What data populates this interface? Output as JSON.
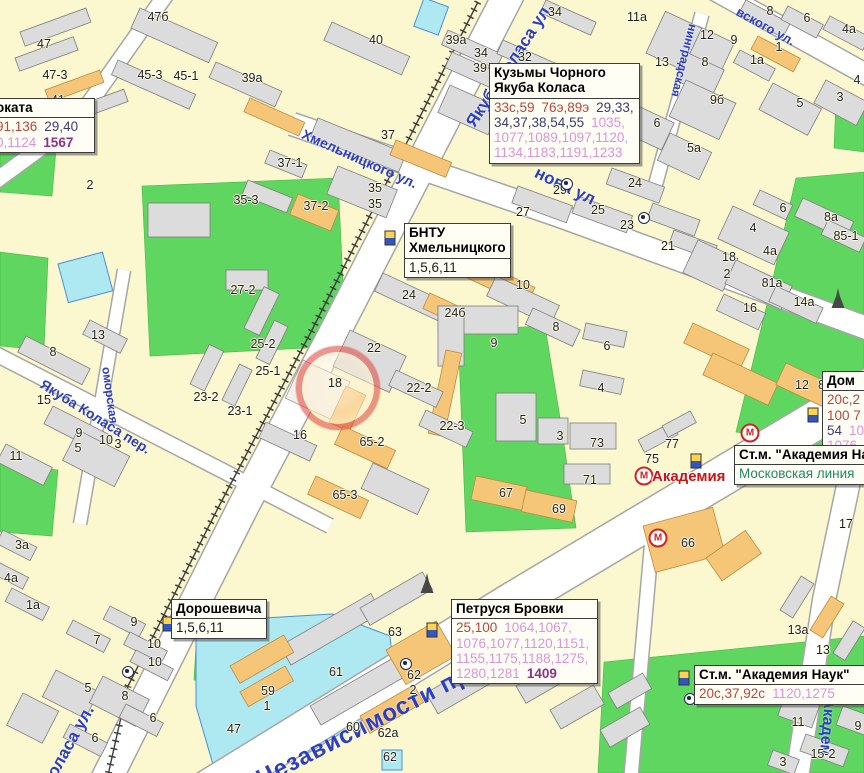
{
  "colors": {
    "map_background": "#FBF7CE",
    "park_green": "#5FD65F",
    "water_cyan": "#AEE9F2",
    "building_gray": "#DCDCDC",
    "building_orange": "#F5C678",
    "street_label_blue": "#2B3FC0",
    "tram_route_red": "#BB4538",
    "bus_route_navy": "#3C3C74",
    "shuttle_route_pink": "#DD92DC",
    "express_purple": "#8E3090",
    "metro_line_teal": "#1E8A66",
    "station_label_red": "#CE1212",
    "highlight_ring_red": "#E05048"
  },
  "icon_glyphs": {
    "metro": "М"
  },
  "street_labels": [
    {
      "name": "yakuba-kolasa-st",
      "text": "Якуба Коласа ул.",
      "x": 462,
      "y": 120,
      "rot": -57,
      "size": 17
    },
    {
      "name": "khmelnitskogo-st",
      "text": "Хмельницкого ул.",
      "x": 306,
      "y": 126,
      "rot": 24,
      "size": 14
    },
    {
      "name": "surganova-st-fragment",
      "text": "нова ул.",
      "x": 540,
      "y": 163,
      "rot": 26,
      "size": 17
    },
    {
      "name": "nezavisimosti-ave",
      "text": "Независимости просп",
      "x": 252,
      "y": 768,
      "rot": -27,
      "size": 24
    },
    {
      "name": "akademicheskaya-st-fragment",
      "text": "Академ",
      "x": 838,
      "y": 698,
      "rot": 95,
      "size": 16
    },
    {
      "name": "belomorskaya-st-fragment",
      "text": "оморская",
      "x": 113,
      "y": 366,
      "rot": 82,
      "size": 12
    },
    {
      "name": "yakuba-kolasa-lane",
      "text": "Якуба Коласа пер.",
      "x": 46,
      "y": 376,
      "rot": 32,
      "size": 14
    },
    {
      "name": "kolasa-st-fragment",
      "text": "Коласа ул.",
      "x": 38,
      "y": 780,
      "rot": -61,
      "size": 17
    },
    {
      "name": "chernyshevskogo-st-fragment",
      "text": "вского ул.",
      "x": 741,
      "y": 4,
      "rot": 29,
      "size": 13
    },
    {
      "name": "leningradskaya-st-fragment",
      "text": "нинградская",
      "x": 700,
      "y": 26,
      "rot": 104,
      "size": 12
    }
  ],
  "building_labels": [
    {
      "t": "47б",
      "x": 158,
      "y": 17
    },
    {
      "t": "47",
      "x": 44,
      "y": 44
    },
    {
      "t": "47-3",
      "x": 55,
      "y": 75
    },
    {
      "t": "45-3",
      "x": 150,
      "y": 75
    },
    {
      "t": "45-1",
      "x": 186,
      "y": 76
    },
    {
      "t": "41",
      "x": 58,
      "y": 100
    },
    {
      "t": "43",
      "x": 85,
      "y": 113
    },
    {
      "t": "40",
      "x": 376,
      "y": 40
    },
    {
      "t": "39а",
      "x": 456,
      "y": 40
    },
    {
      "t": "34",
      "x": 481,
      "y": 53
    },
    {
      "t": "39",
      "x": 480,
      "y": 68
    },
    {
      "t": "32",
      "x": 525,
      "y": 57
    },
    {
      "t": "34",
      "x": 555,
      "y": 12
    },
    {
      "t": "39а",
      "x": 252,
      "y": 78
    },
    {
      "t": "37-1",
      "x": 290,
      "y": 163
    },
    {
      "t": "37",
      "x": 388,
      "y": 135
    },
    {
      "t": "35-3",
      "x": 246,
      "y": 200
    },
    {
      "t": "37-2",
      "x": 316,
      "y": 206
    },
    {
      "t": "35",
      "x": 375,
      "y": 188
    },
    {
      "t": "35",
      "x": 375,
      "y": 204
    },
    {
      "t": "2",
      "x": 90,
      "y": 185
    },
    {
      "t": "27-2",
      "x": 243,
      "y": 290
    },
    {
      "t": "25-2",
      "x": 263,
      "y": 344
    },
    {
      "t": "25-1",
      "x": 268,
      "y": 371
    },
    {
      "t": "23-2",
      "x": 206,
      "y": 397
    },
    {
      "t": "23-1",
      "x": 240,
      "y": 411
    },
    {
      "t": "13",
      "x": 98,
      "y": 335
    },
    {
      "t": "8",
      "x": 53,
      "y": 352
    },
    {
      "t": "15",
      "x": 44,
      "y": 400
    },
    {
      "t": "9",
      "x": 79,
      "y": 433
    },
    {
      "t": "5",
      "x": 78,
      "y": 448
    },
    {
      "t": "10",
      "x": 106,
      "y": 440
    },
    {
      "t": "3",
      "x": 118,
      "y": 444
    },
    {
      "t": "11",
      "x": 16,
      "y": 456
    },
    {
      "t": "11а",
      "x": 637,
      "y": 17
    },
    {
      "t": "12",
      "x": 707,
      "y": 35
    },
    {
      "t": "9",
      "x": 734,
      "y": 40
    },
    {
      "t": "13",
      "x": 662,
      "y": 62
    },
    {
      "t": "8",
      "x": 705,
      "y": 62
    },
    {
      "t": "9б",
      "x": 717,
      "y": 100
    },
    {
      "t": "6",
      "x": 657,
      "y": 123
    },
    {
      "t": "5а",
      "x": 694,
      "y": 148
    },
    {
      "t": "8",
      "x": 770,
      "y": 11
    },
    {
      "t": "6",
      "x": 807,
      "y": 18
    },
    {
      "t": "4а",
      "x": 849,
      "y": 29
    },
    {
      "t": "1",
      "x": 779,
      "y": 47
    },
    {
      "t": "1а",
      "x": 757,
      "y": 60
    },
    {
      "t": "5",
      "x": 800,
      "y": 103
    },
    {
      "t": "3",
      "x": 840,
      "y": 97
    },
    {
      "t": "4",
      "x": 857,
      "y": 80
    },
    {
      "t": "29",
      "x": 560,
      "y": 190
    },
    {
      "t": "27",
      "x": 523,
      "y": 212
    },
    {
      "t": "25",
      "x": 598,
      "y": 210
    },
    {
      "t": "24",
      "x": 635,
      "y": 183
    },
    {
      "t": "23",
      "x": 627,
      "y": 225
    },
    {
      "t": "21",
      "x": 668,
      "y": 246
    },
    {
      "t": "24",
      "x": 409,
      "y": 295
    },
    {
      "t": "24б",
      "x": 455,
      "y": 313
    },
    {
      "t": "10",
      "x": 523,
      "y": 285
    },
    {
      "t": "9",
      "x": 494,
      "y": 343
    },
    {
      "t": "8",
      "x": 556,
      "y": 327
    },
    {
      "t": "6",
      "x": 607,
      "y": 346
    },
    {
      "t": "4",
      "x": 601,
      "y": 388
    },
    {
      "t": "5",
      "x": 523,
      "y": 420
    },
    {
      "t": "3",
      "x": 560,
      "y": 436
    },
    {
      "t": "22",
      "x": 374,
      "y": 348
    },
    {
      "t": "18",
      "x": 335,
      "y": 383
    },
    {
      "t": "22-2",
      "x": 419,
      "y": 388
    },
    {
      "t": "22-3",
      "x": 452,
      "y": 426
    },
    {
      "t": "16",
      "x": 300,
      "y": 435
    },
    {
      "t": "65-2",
      "x": 372,
      "y": 442
    },
    {
      "t": "65-3",
      "x": 345,
      "y": 495
    },
    {
      "t": "73",
      "x": 597,
      "y": 443
    },
    {
      "t": "71",
      "x": 590,
      "y": 480
    },
    {
      "t": "67",
      "x": 506,
      "y": 493
    },
    {
      "t": "69",
      "x": 559,
      "y": 509
    },
    {
      "t": "18",
      "x": 729,
      "y": 257
    },
    {
      "t": "2",
      "x": 727,
      "y": 274
    },
    {
      "t": "4",
      "x": 753,
      "y": 228
    },
    {
      "t": "4а",
      "x": 770,
      "y": 251
    },
    {
      "t": "6",
      "x": 783,
      "y": 208
    },
    {
      "t": "8а",
      "x": 831,
      "y": 217
    },
    {
      "t": "85-1",
      "x": 846,
      "y": 236
    },
    {
      "t": "81а",
      "x": 772,
      "y": 283
    },
    {
      "t": "16",
      "x": 750,
      "y": 308
    },
    {
      "t": "14а",
      "x": 804,
      "y": 302
    },
    {
      "t": "12",
      "x": 802,
      "y": 385
    },
    {
      "t": "81",
      "x": 825,
      "y": 385
    },
    {
      "t": "75",
      "x": 652,
      "y": 459
    },
    {
      "t": "77",
      "x": 672,
      "y": 444
    },
    {
      "t": "66",
      "x": 688,
      "y": 543
    },
    {
      "t": "17",
      "x": 846,
      "y": 524
    },
    {
      "t": "47",
      "x": 234,
      "y": 729
    },
    {
      "t": "59",
      "x": 268,
      "y": 691
    },
    {
      "t": "1",
      "x": 267,
      "y": 706
    },
    {
      "t": "61",
      "x": 336,
      "y": 672
    },
    {
      "t": "63",
      "x": 395,
      "y": 632
    },
    {
      "t": "62",
      "x": 414,
      "y": 675
    },
    {
      "t": "2",
      "x": 413,
      "y": 690
    },
    {
      "t": "60",
      "x": 353,
      "y": 727
    },
    {
      "t": "62а",
      "x": 388,
      "y": 733
    },
    {
      "t": "62",
      "x": 390,
      "y": 757
    },
    {
      "t": "3а",
      "x": 22,
      "y": 545
    },
    {
      "t": "4а",
      "x": 11,
      "y": 578
    },
    {
      "t": "1а",
      "x": 33,
      "y": 605
    },
    {
      "t": "9",
      "x": 134,
      "y": 622
    },
    {
      "t": "7",
      "x": 97,
      "y": 640
    },
    {
      "t": "10",
      "x": 154,
      "y": 644
    },
    {
      "t": "10",
      "x": 155,
      "y": 662
    },
    {
      "t": "5",
      "x": 88,
      "y": 688
    },
    {
      "t": "8",
      "x": 125,
      "y": 696
    },
    {
      "t": "6",
      "x": 153,
      "y": 718
    },
    {
      "t": "6",
      "x": 95,
      "y": 738
    },
    {
      "t": "13а",
      "x": 798,
      "y": 630
    },
    {
      "t": "13",
      "x": 823,
      "y": 650
    },
    {
      "t": "11",
      "x": 798,
      "y": 722
    },
    {
      "t": "15-2",
      "x": 823,
      "y": 754
    },
    {
      "t": "9",
      "x": 858,
      "y": 726
    },
    {
      "t": "3",
      "x": 783,
      "y": 762
    }
  ],
  "info_boxes": [
    {
      "name": "prokat-callout",
      "x": -8,
      "y": 98,
      "w": 102,
      "clip": "left",
      "title_lines": [
        "оката"
      ],
      "rows": [
        [
          {
            "t": "91,136",
            "c": "red"
          },
          {
            "t": "29,40",
            "c": "bus"
          }
        ],
        [
          {
            "t": "0,1124",
            "c": "taxi"
          },
          {
            "t": "1567",
            "c": "purple"
          }
        ]
      ]
    },
    {
      "name": "kuzmy-chornogo-callout",
      "x": 489,
      "y": 63,
      "w": 149,
      "title_lines": [
        "Кузьмы Чорного",
        "Якуба Коласа"
      ],
      "rows": [
        [
          {
            "t": "33с,59",
            "c": "red"
          },
          {
            "t": "76э,89э",
            "c": "red"
          },
          {
            "t": "29,33,",
            "c": "bus"
          }
        ],
        [
          {
            "t": "34,37,38,54,55",
            "c": "bus"
          },
          {
            "t": "1035,",
            "c": "taxi"
          }
        ],
        [
          {
            "t": "1077,1089,1097,1120,",
            "c": "taxi"
          }
        ],
        [
          {
            "t": "1134,1183,1191,1233",
            "c": "taxi"
          }
        ]
      ]
    },
    {
      "name": "bntu-callout",
      "x": 404,
      "y": 223,
      "w": 105,
      "title_lines": [
        "БНТУ",
        "Хмельницкого"
      ],
      "rows": [
        [
          {
            "t": "1,5,6,11",
            "c": "black"
          }
        ]
      ]
    },
    {
      "name": "doroshevicha-callout",
      "x": 171,
      "y": 599,
      "w": 94,
      "title_lines": [
        "Дорошевича"
      ],
      "rows": [
        [
          {
            "t": "1,5,6,11",
            "c": "black"
          }
        ]
      ]
    },
    {
      "name": "petrusya-brovki-callout",
      "x": 451,
      "y": 599,
      "w": 145,
      "title_lines": [
        "Петруся Бровки"
      ],
      "rows": [
        [
          {
            "t": "25,100",
            "c": "red"
          },
          {
            "t": "1064,1067,",
            "c": "taxi"
          }
        ],
        [
          {
            "t": "1076,1077,1120,1151,",
            "c": "taxi"
          }
        ],
        [
          {
            "t": "1155,1175,1188,1275,",
            "c": "taxi"
          }
        ],
        [
          {
            "t": "1280,1281",
            "c": "taxi"
          },
          {
            "t": "1409",
            "c": "purple"
          }
        ]
      ]
    },
    {
      "name": "dom-callout",
      "x": 822,
      "y": 371,
      "w": 80,
      "title_lines": [
        "Дом"
      ],
      "rows": [
        [
          {
            "t": "20с,2",
            "c": "red"
          }
        ],
        [
          {
            "t": "100 7",
            "c": "red"
          }
        ],
        [
          {
            "t": "54",
            "c": "bus"
          },
          {
            "t": "10",
            "c": "taxi"
          }
        ],
        [
          {
            "t": "1076,",
            "c": "taxi"
          }
        ],
        [
          {
            "t": "1120",
            "c": "taxi"
          }
        ]
      ]
    },
    {
      "name": "academia-station-callout",
      "x": 734,
      "y": 445,
      "w": 150,
      "title_lines": [
        "Ст.м. \"Академия На"
      ],
      "rows": [
        [
          {
            "t": "Московская линия",
            "c": "teal"
          }
        ]
      ]
    },
    {
      "name": "academia-nauk-callout",
      "x": 694,
      "y": 665,
      "w": 186,
      "title_lines": [
        "Ст.м. \"Академия Наук\""
      ],
      "rows": [
        [
          {
            "t": "20с,37,92с",
            "c": "red"
          },
          {
            "t": "1120,1275",
            "c": "taxi"
          }
        ]
      ]
    }
  ],
  "icons": [
    {
      "type": "metro",
      "x": 750,
      "y": 433
    },
    {
      "type": "metro",
      "x": 644,
      "y": 476
    },
    {
      "type": "metro",
      "x": 658,
      "y": 538
    },
    {
      "type": "tram-stop",
      "x": 390,
      "y": 238
    },
    {
      "type": "tram-stop",
      "x": 168,
      "y": 624
    },
    {
      "type": "tram-stop",
      "x": 684,
      "y": 678
    },
    {
      "type": "tram-stop",
      "x": 813,
      "y": 415
    },
    {
      "type": "tram-stop",
      "x": 432,
      "y": 630
    },
    {
      "type": "tram-stop",
      "x": 696,
      "y": 461
    },
    {
      "type": "poi-dot",
      "x": 567,
      "y": 184
    },
    {
      "type": "poi-dot",
      "x": 644,
      "y": 218
    },
    {
      "type": "poi-dot",
      "x": 406,
      "y": 664
    },
    {
      "type": "poi-dot",
      "x": 690,
      "y": 699
    },
    {
      "type": "poi-dot",
      "x": 128,
      "y": 672
    },
    {
      "type": "tower",
      "x": 427,
      "y": 590
    },
    {
      "type": "tower",
      "x": 838,
      "y": 305
    },
    {
      "type": "glow",
      "x": 846,
      "y": 447
    }
  ],
  "highlight": {
    "x": 338,
    "y": 388,
    "r": 42
  },
  "station_label": {
    "text": "Академия",
    "x": 652,
    "y": 468
  }
}
